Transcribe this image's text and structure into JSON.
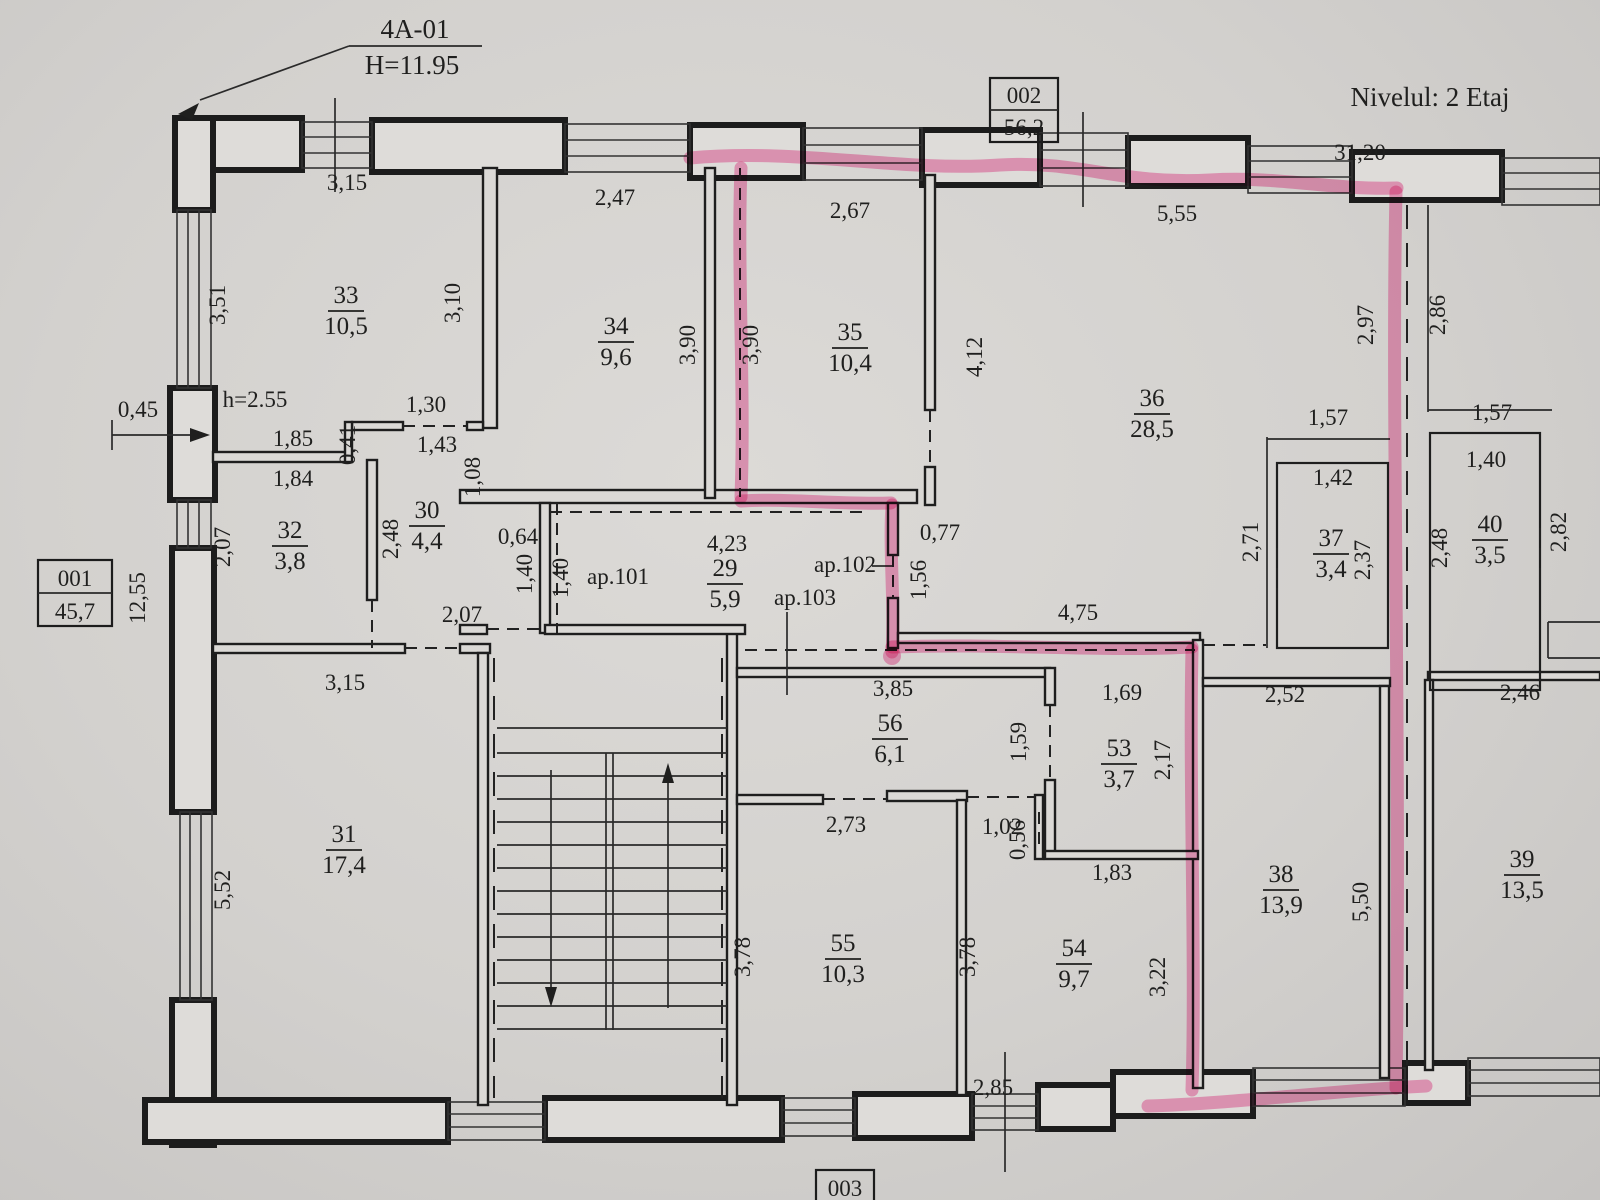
{
  "meta": {
    "section_ref": "4A-01",
    "section_height": "H=11.95",
    "level_label": "Nivelul: 2 Etaj",
    "ceiling_height": "h=2.55"
  },
  "unit_boxes": {
    "b001": {
      "id": "001",
      "area": "45,7"
    },
    "b002": {
      "id": "002",
      "area": "56,2"
    },
    "b003": {
      "id": "003"
    }
  },
  "apartments": {
    "a101": "ap.101",
    "a102": "ap.102",
    "a103": "ap.103"
  },
  "rooms": {
    "r29": {
      "n": "29",
      "a": "5,9"
    },
    "r30": {
      "n": "30",
      "a": "4,4"
    },
    "r31": {
      "n": "31",
      "a": "17,4"
    },
    "r32": {
      "n": "32",
      "a": "3,8"
    },
    "r33": {
      "n": "33",
      "a": "10,5"
    },
    "r34": {
      "n": "34",
      "a": "9,6"
    },
    "r35": {
      "n": "35",
      "a": "10,4"
    },
    "r36": {
      "n": "36",
      "a": "28,5"
    },
    "r37": {
      "n": "37",
      "a": "3,4"
    },
    "r38": {
      "n": "38",
      "a": "13,9"
    },
    "r39": {
      "n": "39",
      "a": "13,5"
    },
    "r40": {
      "n": "40",
      "a": "3,5"
    },
    "r53": {
      "n": "53",
      "a": "3,7"
    },
    "r54": {
      "n": "54",
      "a": "9,7"
    },
    "r55": {
      "n": "55",
      "a": "10,3"
    },
    "r56": {
      "n": "56",
      "a": "6,1"
    }
  },
  "dims": {
    "t315a": "3,15",
    "t247": "2,47",
    "t267": "2,67",
    "t555": "5,55",
    "t3120": "31,20",
    "l351": "3,51",
    "l045": "0,45",
    "l1255": "12,55",
    "l552": "5,52",
    "q130": "1,30",
    "q185": "1,85",
    "q041": "0,41",
    "q143": "1,43",
    "q184": "1,84",
    "q108": "1,08",
    "q207v": "2,07",
    "q248": "2,48",
    "r310": "3,10",
    "m390a": "3,90",
    "m390b": "3,90",
    "m412": "4,12",
    "c064": "0,64",
    "c140a": "1,40",
    "c140b": "1,40",
    "c423": "4,23",
    "c077": "0,77",
    "c156": "1,56",
    "c207": "2,07",
    "e297": "2,97",
    "e286": "2,86",
    "e157a": "1,57",
    "e157b": "1,57",
    "e142": "1,42",
    "e140": "1,40",
    "e271": "2,71",
    "e237": "2,37",
    "e248": "2,48",
    "e282": "2,82",
    "f475": "4,75",
    "f315": "3,15",
    "f385": "3,85",
    "f169": "1,69",
    "f252": "2,52",
    "f246": "2,46",
    "f159": "1,59",
    "f217": "2,17",
    "g273": "2,73",
    "g102": "1,02",
    "g056": "0,56",
    "g183": "1,83",
    "g550": "5,50",
    "g378a": "3,78",
    "g378b": "3,78",
    "g322": "3,22",
    "g285": "2,85"
  },
  "colors": {
    "highlight": "#f768aa",
    "ink": "#1f1f1e",
    "paper": "#d6d4d1"
  }
}
